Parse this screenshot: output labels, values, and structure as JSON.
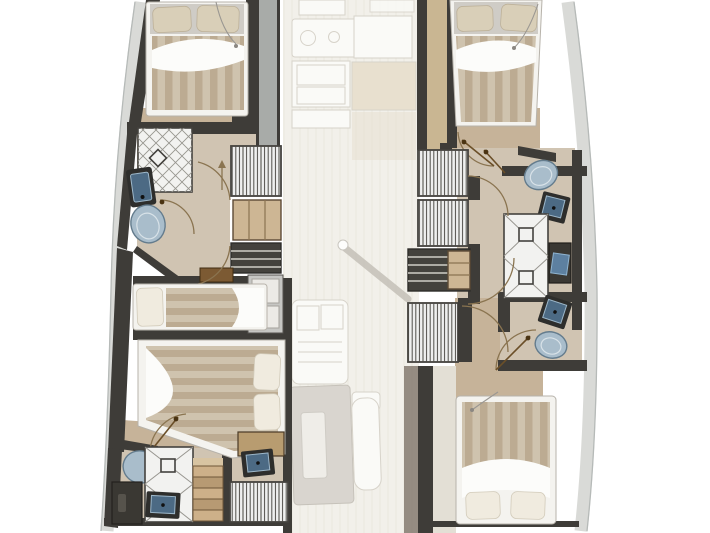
{
  "figure": {
    "label": "Catamaran yacht interior floor plan, lower deck cabins over faded bridge-deck saloon",
    "type": "floor-plan"
  },
  "colors": {
    "wall": "#3e3c38",
    "hullband": "#d9dad7",
    "hulline": "#b6bab8",
    "floor_tan": "#c6b399",
    "floor_tan2": "#c9b692",
    "floor_bath": "#d0c4b2",
    "deckgray": "#a8aba8",
    "bedframe": "#f4f3ef",
    "sheet": "#fcfcfa",
    "pillow": "#d9cfb8",
    "pillow2": "#f0ebdf",
    "duvA": "#cfc3ae",
    "duvB": "#bcab92",
    "tilebg": "#f2f2f0",
    "tileline": "#97958f",
    "tileframe": "#44423e",
    "hatchbg": "#eff0ef",
    "hatchline": "#4c4a45",
    "slatbg": "#44423d",
    "slatline": "#d0cec7",
    "shelfwood": "#cdb694",
    "stairwood_a": "#cdb089",
    "stairwood_b": "#b79a73",
    "brshelf": "#7c5a33",
    "deskwood": "#b89c70",
    "sinkframe": "#2e2e2c",
    "sinkbasin": "#4c6a84",
    "sinklight": "#9db7c9",
    "toiletfill": "#a9bdcb",
    "toiletstroke": "#647c8d",
    "counter": "#fafaf7",
    "counterline": "#d7d3ca",
    "faded_bg": "#f2f0ea",
    "faded_wood": "#e8e0cf",
    "table": "#d9d5cf",
    "tableinner": "#efede8",
    "fadedbrown": "#7d7368",
    "headboard": "#cfccc6",
    "cabinet": "#c6c6c3",
    "cabinetinner": "#eceae6",
    "darkcab": "#3a3833",
    "screenblue": "#5d80a0",
    "arc": "#8a7450",
    "leaf": "#6b4f28",
    "leafdot": "#4a3312",
    "cord": "#9a9792",
    "mast_shadow": "#c2beb5",
    "palefloor": "#e3dfd5"
  },
  "decks": {
    "bridge_deck_faded": {
      "rooms": [
        {
          "name": "galley",
          "fixtures": [
            "worktop",
            "double-sink",
            "cabinets",
            "fridge",
            "wood-floor"
          ]
        },
        {
          "name": "saloon",
          "fixtures": [
            "mast-foot",
            "chart-seat",
            "table",
            "bench"
          ]
        }
      ]
    },
    "port_hull": {
      "rooms": [
        {
          "name": "forward-cabin",
          "fixtures": [
            "double-bed",
            "pillows",
            "reading-light-cord"
          ]
        },
        {
          "name": "forward-bathroom",
          "fixtures": [
            "shower",
            "washbasin",
            "toilet",
            "door"
          ]
        },
        {
          "name": "companionway",
          "fixtures": [
            "stairs",
            "shelving",
            "lockers",
            "cabinet"
          ]
        },
        {
          "name": "midship-berth",
          "fixtures": [
            "single-berth",
            "pillow",
            "shelf"
          ]
        },
        {
          "name": "aft-cabin",
          "fixtures": [
            "double-bed",
            "pillows",
            "vanity-desk",
            "door"
          ]
        },
        {
          "name": "aft-bathroom",
          "fixtures": [
            "toilet",
            "shower",
            "washbasin",
            "cabinet",
            "stairs",
            "washbasin",
            "louver-locker"
          ]
        }
      ]
    },
    "starboard_hull": {
      "rooms": [
        {
          "name": "forward-cabin",
          "fixtures": [
            "double-bed",
            "pillows",
            "reading-light-cord",
            "door"
          ]
        },
        {
          "name": "companionway",
          "fixtures": [
            "stairs",
            "louver-locker",
            "slat-lockers",
            "shelving"
          ]
        },
        {
          "name": "midship-bathroom",
          "fixtures": [
            "toilet",
            "washbasin",
            "shower",
            "shower",
            "vanity-cabinet"
          ]
        },
        {
          "name": "aft-bathroom",
          "fixtures": [
            "washbasin",
            "toilet",
            "door"
          ]
        },
        {
          "name": "aft-cabin",
          "fixtures": [
            "double-bed",
            "pillows",
            "reading-light-cord"
          ]
        }
      ]
    }
  },
  "counts": {
    "cabins": 4,
    "berths": 1,
    "bathrooms": 4,
    "showers": 5,
    "toilets": 4,
    "washbasins": 6
  }
}
